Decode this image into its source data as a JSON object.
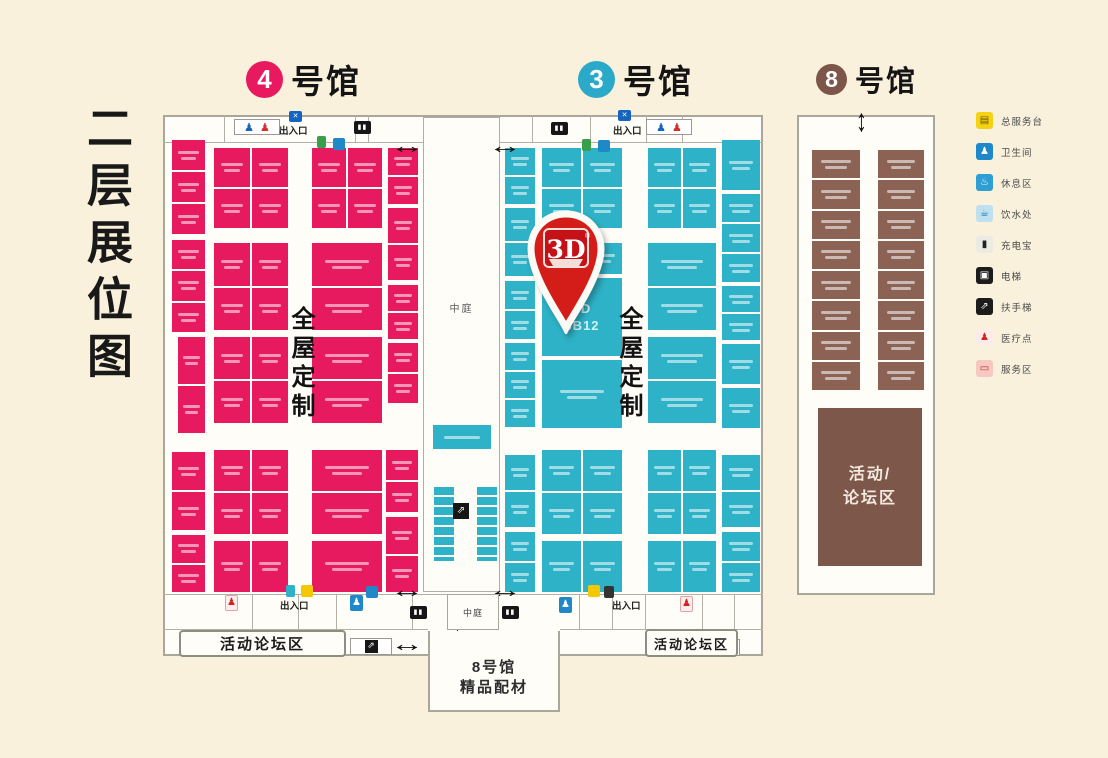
{
  "title": "二层展位图",
  "halls": [
    {
      "num": "4",
      "suffix": "号馆",
      "color": "#e8195f"
    },
    {
      "num": "3",
      "suffix": "号馆",
      "color": "#2aa9c8"
    },
    {
      "num": "8",
      "suffix": "号馆",
      "color": "#7b5649"
    }
  ],
  "pin": {
    "text": "3D",
    "reg": "®"
  },
  "zones": {
    "atrium": "中庭",
    "atrium_small": "中庭",
    "whole_house_custom": "全屋定制",
    "entrance": "出入口",
    "forum_left": "活动论坛区",
    "forum_right": "活动论坛区",
    "hall8_brown_forum": [
      "活动/",
      "论坛区"
    ],
    "hall8_passage": [
      "8号馆",
      "精品配材"
    ]
  },
  "legend": [
    {
      "label": "总服务台",
      "bg": "#f5d312",
      "fg": "#6b5500",
      "glyph": "▤",
      "icon": "service-desk-icon"
    },
    {
      "label": "卫生间",
      "bg": "#1e88c9",
      "fg": "#ffffff",
      "glyph": "♟",
      "icon": "mens-restroom-icon"
    },
    {
      "label": "休息区",
      "bg": "#2f9fd3",
      "fg": "#ffffff",
      "glyph": "♨",
      "icon": "rest-area-icon"
    },
    {
      "label": "饮水处",
      "bg": "#bfe0ef",
      "fg": "#1668a8",
      "glyph": "☕",
      "icon": "drinking-water-icon"
    },
    {
      "label": "充电宝",
      "bg": "#ecebe3",
      "fg": "#222222",
      "glyph": "▮",
      "icon": "power-bank-icon"
    },
    {
      "label": "电梯",
      "bg": "#1c1c1c",
      "fg": "#ffffff",
      "glyph": "▣",
      "icon": "elevator-icon"
    },
    {
      "label": "扶手梯",
      "bg": "#1c1c1c",
      "fg": "#ffffff",
      "glyph": "⇗",
      "icon": "escalator-icon"
    },
    {
      "label": "医疗点",
      "bg": "#fbecea",
      "fg": "#d6231f",
      "glyph": "♟",
      "icon": "medical-icon"
    },
    {
      "label": "服务区",
      "bg": "#f6c8c4",
      "fg": "#c62a22",
      "glyph": "▭",
      "icon": "service-area-icon"
    }
  ],
  "map": {
    "colors": {
      "pink": "#e71a5f",
      "teal": "#2eb2c7",
      "brown": "#8b6254"
    },
    "hall_groups": [
      {
        "name": "hall4-booths",
        "color": "#e71a5f",
        "blocks": [
          [
            172,
            140,
            33,
            94,
            3,
            1
          ],
          [
            172,
            240,
            33,
            92,
            3,
            1
          ],
          [
            178,
            337,
            27,
            96,
            2,
            1
          ],
          [
            172,
            452,
            33,
            78,
            2,
            1
          ],
          [
            172,
            535,
            33,
            57,
            2,
            1
          ],
          [
            214,
            148,
            74,
            80,
            2,
            2
          ],
          [
            214,
            243,
            74,
            87,
            2,
            2
          ],
          [
            214,
            337,
            74,
            86,
            2,
            2
          ],
          [
            214,
            450,
            74,
            84,
            2,
            2
          ],
          [
            214,
            541,
            74,
            51,
            1,
            2
          ],
          [
            312,
            148,
            70,
            80,
            2,
            2
          ],
          [
            312,
            243,
            70,
            87,
            2,
            1
          ],
          [
            312,
            337,
            70,
            86,
            2,
            1
          ],
          [
            312,
            450,
            70,
            84,
            2,
            1
          ],
          [
            312,
            541,
            70,
            51,
            1,
            1
          ],
          [
            388,
            148,
            30,
            56,
            2,
            1
          ],
          [
            388,
            208,
            30,
            72,
            2,
            1
          ],
          [
            388,
            285,
            30,
            54,
            2,
            1
          ],
          [
            388,
            343,
            30,
            60,
            2,
            1
          ],
          [
            386,
            450,
            32,
            62,
            2,
            1
          ],
          [
            386,
            517,
            32,
            75,
            2,
            1
          ]
        ]
      },
      {
        "name": "hall3-booths",
        "color": "#2eb2c7",
        "blocks": [
          [
            505,
            148,
            30,
            56,
            2,
            1
          ],
          [
            505,
            208,
            30,
            68,
            2,
            1
          ],
          [
            505,
            281,
            30,
            58,
            2,
            1
          ],
          [
            505,
            343,
            30,
            84,
            3,
            1
          ],
          [
            505,
            455,
            30,
            72,
            2,
            1
          ],
          [
            505,
            532,
            30,
            60,
            2,
            1
          ],
          [
            542,
            148,
            80,
            80,
            2,
            2
          ],
          [
            542,
            243,
            80,
            31,
            1,
            2
          ],
          [
            542,
            360,
            80,
            68,
            1,
            1
          ],
          [
            542,
            450,
            80,
            84,
            2,
            2
          ],
          [
            542,
            541,
            80,
            51,
            1,
            2
          ],
          [
            648,
            148,
            68,
            80,
            2,
            2
          ],
          [
            648,
            243,
            68,
            87,
            2,
            1
          ],
          [
            648,
            337,
            68,
            86,
            2,
            1
          ],
          [
            648,
            450,
            68,
            84,
            2,
            2
          ],
          [
            648,
            541,
            68,
            51,
            1,
            2
          ],
          [
            722,
            140,
            38,
            50,
            1,
            1
          ],
          [
            722,
            194,
            38,
            88,
            3,
            1
          ],
          [
            722,
            286,
            38,
            54,
            2,
            1
          ],
          [
            722,
            344,
            38,
            40,
            1,
            1
          ],
          [
            722,
            388,
            38,
            40,
            1,
            1
          ],
          [
            722,
            455,
            38,
            72,
            2,
            1
          ],
          [
            722,
            532,
            38,
            60,
            2,
            1
          ],
          [
            433,
            425,
            58,
            24,
            1,
            1
          ]
        ]
      },
      {
        "name": "hall8-booths",
        "color": "#8b6254",
        "blocks": [
          [
            812,
            150,
            48,
            240,
            8,
            1
          ],
          [
            878,
            150,
            46,
            240,
            8,
            1
          ]
        ]
      }
    ],
    "special_booths": [
      {
        "x": 542,
        "y": 278,
        "w": 80,
        "h": 78,
        "c": "#2eb2c7",
        "lines": [
          "3D",
          "3B12"
        ],
        "name": "booth-3b12"
      }
    ],
    "stalls": [
      [
        434,
        487
      ],
      [
        477,
        487
      ]
    ],
    "hlines": [
      [
        163,
        423,
        143
      ],
      [
        500,
        763,
        143
      ],
      [
        163,
        447,
        595
      ],
      [
        499,
        763,
        595
      ],
      [
        163,
        428,
        630
      ],
      [
        560,
        763,
        630
      ]
    ],
    "separators": [
      [
        224,
        115,
        143
      ],
      [
        355,
        115,
        143
      ],
      [
        368,
        115,
        143
      ],
      [
        532,
        115,
        143
      ],
      [
        590,
        115,
        143
      ],
      [
        646,
        115,
        143
      ],
      [
        682,
        115,
        143
      ],
      [
        252,
        595,
        630
      ],
      [
        298,
        595,
        630
      ],
      [
        336,
        595,
        630
      ],
      [
        412,
        595,
        630
      ],
      [
        579,
        595,
        630
      ],
      [
        612,
        595,
        630
      ],
      [
        645,
        595,
        630
      ],
      [
        702,
        595,
        630
      ],
      [
        734,
        595,
        630
      ]
    ],
    "icons": [
      {
        "t": "wcpair",
        "x": 234,
        "y": 119
      },
      {
        "t": "wcpair",
        "x": 646,
        "y": 119
      },
      {
        "t": "screen",
        "x": 289,
        "y": 111
      },
      {
        "t": "screen",
        "x": 618,
        "y": 110
      },
      {
        "t": "elev",
        "x": 354,
        "y": 121
      },
      {
        "t": "elev",
        "x": 551,
        "y": 122
      },
      {
        "t": "green",
        "x": 317,
        "y": 136
      },
      {
        "t": "bluesm",
        "x": 333,
        "y": 138
      },
      {
        "t": "green",
        "x": 582,
        "y": 139
      },
      {
        "t": "bluesm",
        "x": 598,
        "y": 140
      },
      {
        "t": "wcf",
        "x": 225,
        "y": 595
      },
      {
        "t": "wcm",
        "x": 350,
        "y": 595
      },
      {
        "t": "wcm",
        "x": 559,
        "y": 597
      },
      {
        "t": "wcf",
        "x": 680,
        "y": 596
      },
      {
        "t": "tealsm",
        "x": 286,
        "y": 585
      },
      {
        "t": "yellow",
        "x": 301,
        "y": 585
      },
      {
        "t": "bluesm",
        "x": 366,
        "y": 586
      },
      {
        "t": "yellow",
        "x": 588,
        "y": 585
      },
      {
        "t": "darksm",
        "x": 604,
        "y": 586
      },
      {
        "t": "elev",
        "x": 410,
        "y": 606
      },
      {
        "t": "elev",
        "x": 502,
        "y": 606
      },
      {
        "t": "escbox",
        "x": 350,
        "y": 638
      },
      {
        "t": "escbox",
        "x": 698,
        "y": 639
      },
      {
        "t": "escsm",
        "x": 453,
        "y": 503
      }
    ],
    "arrows": [
      {
        "d": "h",
        "x": 396,
        "y": 135
      },
      {
        "d": "h",
        "x": 494,
        "y": 135
      },
      {
        "d": "h",
        "x": 396,
        "y": 579
      },
      {
        "d": "h",
        "x": 494,
        "y": 579
      },
      {
        "d": "h",
        "x": 396,
        "y": 633
      },
      {
        "d": "h",
        "x": 494,
        "y": 633
      },
      {
        "d": "v",
        "x": 452,
        "y": 620
      },
      {
        "d": "v",
        "x": 856,
        "y": 110
      }
    ],
    "labels": [
      {
        "k": "entr",
        "t": "出入口",
        "x": 279,
        "y": 123
      },
      {
        "k": "entr",
        "t": "出入口",
        "x": 613,
        "y": 123
      },
      {
        "k": "entr",
        "t": "出入口",
        "x": 280,
        "y": 598
      },
      {
        "k": "entr",
        "t": "出入口",
        "x": 612,
        "y": 598
      },
      {
        "k": "zonev",
        "t": "全屋定制",
        "x": 288,
        "y": 306
      },
      {
        "k": "zonev",
        "t": "全屋定制",
        "x": 616,
        "y": 306
      },
      {
        "k": "atr",
        "t": "中庭",
        "x": 424,
        "y": 300,
        "w": 75
      },
      {
        "k": "atrs",
        "t": "中庭",
        "x": 447,
        "y": 594,
        "w": 52,
        "h": 36
      },
      {
        "k": "fbox",
        "t": "活动论坛区",
        "x": 179,
        "y": 630,
        "w": 167,
        "h": 27,
        "fs": 15
      },
      {
        "k": "fbox",
        "t": "活动论坛区",
        "x": 645,
        "y": 629,
        "w": 93,
        "h": 28,
        "fs": 13
      }
    ]
  }
}
